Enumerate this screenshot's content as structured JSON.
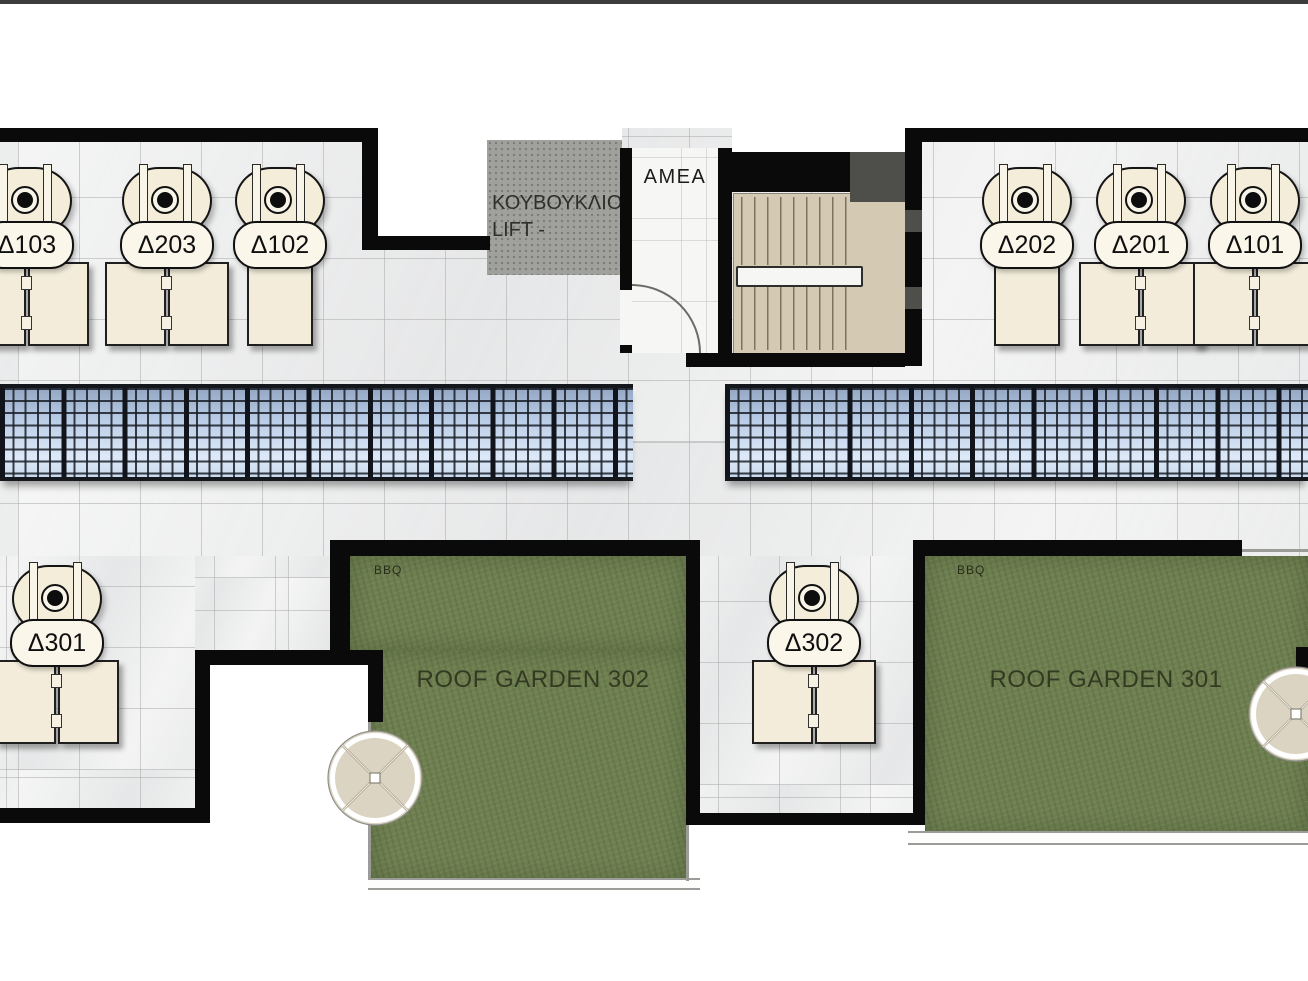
{
  "title": "Roof floor plan",
  "rooms": {
    "lift_line1": "ΚΟΥΒΟΥΚΛΙΟ",
    "lift_line2": "LIFT -",
    "amea": "AMEA"
  },
  "units": [
    {
      "id": "D103",
      "label": "Δ103",
      "cx": 25,
      "top": 167,
      "panels": 2
    },
    {
      "id": "D203",
      "label": "Δ203",
      "cx": 165,
      "top": 167,
      "panels": 2
    },
    {
      "id": "D102",
      "label": "Δ102",
      "cx": 278,
      "top": 167,
      "panels": 1
    },
    {
      "id": "D202",
      "label": "Δ202",
      "cx": 1025,
      "top": 167,
      "panels": 1
    },
    {
      "id": "D201",
      "label": "Δ201",
      "cx": 1139,
      "top": 167,
      "panels": 2
    },
    {
      "id": "D101",
      "label": "Δ101",
      "cx": 1253,
      "top": 167,
      "panels": 2
    },
    {
      "id": "D301",
      "label": "Δ301",
      "cx": 55,
      "top": 565,
      "panels": 2
    },
    {
      "id": "D302",
      "label": "Δ302",
      "cx": 812,
      "top": 565,
      "panels": 2
    }
  ],
  "gardens": [
    {
      "name": "ROOF GARDEN 302",
      "bbq": "BBQ"
    },
    {
      "name": "ROOF GARDEN 301",
      "bbq": "BBQ"
    }
  ],
  "parasols": [
    {
      "cx": 375,
      "cy": 778,
      "r": 47
    },
    {
      "cx": 1296,
      "cy": 714,
      "r": 47
    }
  ],
  "colors": {
    "wall": "#0a0a0a",
    "tile": "#ecedec",
    "garden": "#6e7f50",
    "stair": "#d4cab3",
    "lift": "#a0a09d",
    "cream": "#f4edda",
    "solar_blue": "#b9cce6",
    "solar_frame": "#14181d"
  }
}
